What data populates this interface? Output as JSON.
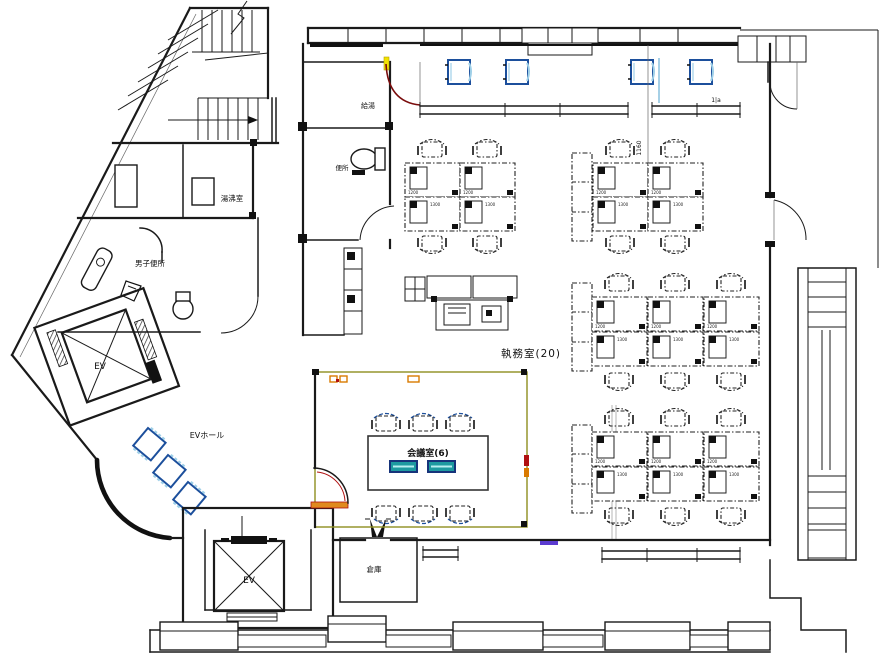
{
  "labels": {
    "office": "執務室(20)",
    "meeting_room": "会議室(6)",
    "ev_hall": "EVホール",
    "elevator_upper": "EV",
    "elevator_lower": "EV",
    "mens_toilet": "男子便所",
    "hot_water_room": "湯沸室",
    "toilet": "便所",
    "kitchenette": "給湯",
    "storage": "倉庫"
  },
  "dimensions": {
    "grid": "1160",
    "counter": "1|a",
    "desk_depth_a": "1200",
    "desk_depth_b": "1300"
  },
  "colors": {
    "wall": "#1a1a1a",
    "chair_blue": "#1c4f9c",
    "chair_blue_light": "#9fd0e8",
    "meeting_outline": "#8f8f1f",
    "door_red": "#b01010",
    "door_dark_red": "#7a0c0c",
    "door_orange": "#d97a00",
    "jamb_yellow": "#f2e200",
    "monitor_teal": "#1d9aa0",
    "monitor_navy": "#16337a",
    "accent_purple": "#5b3bd0"
  }
}
